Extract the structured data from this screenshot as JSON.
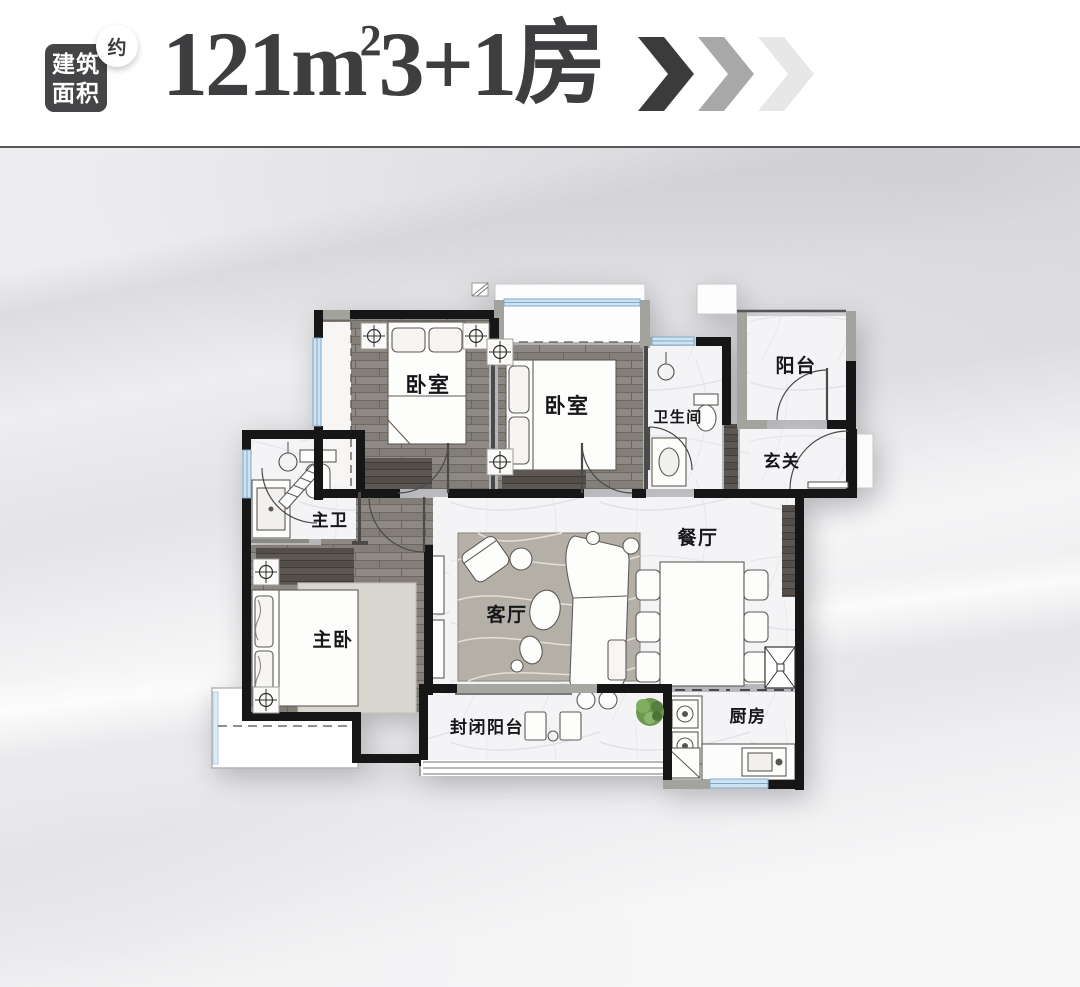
{
  "header": {
    "badge": {
      "line1": "建筑",
      "line2": "面积",
      "approx": "约"
    },
    "title": {
      "number_unit": "121m",
      "superscript": "2",
      "suffix": "3+1房"
    },
    "chevrons": [
      "#3b3b3b",
      "#a8a8a8",
      "#e7e7e7"
    ]
  },
  "floorplan": {
    "rooms": [
      {
        "id": "bedroom-1",
        "label": "卧室",
        "x": 428,
        "y": 392,
        "size": 21
      },
      {
        "id": "bedroom-2",
        "label": "卧室",
        "x": 567,
        "y": 413,
        "size": 21
      },
      {
        "id": "bathroom",
        "label": "卫生间",
        "x": 678,
        "y": 422,
        "size": 15
      },
      {
        "id": "balcony",
        "label": "阳台",
        "x": 796,
        "y": 372,
        "size": 19
      },
      {
        "id": "foyer",
        "label": "玄关",
        "x": 782,
        "y": 467,
        "size": 17
      },
      {
        "id": "dining-room",
        "label": "餐厅",
        "x": 698,
        "y": 544,
        "size": 19
      },
      {
        "id": "living-room",
        "label": "客厅",
        "x": 507,
        "y": 621,
        "size": 19
      },
      {
        "id": "master-bathroom",
        "label": "主卫",
        "x": 330,
        "y": 526,
        "size": 17
      },
      {
        "id": "master-bedroom",
        "label": "主卧",
        "x": 333,
        "y": 646,
        "size": 19
      },
      {
        "id": "enclosed-balcony",
        "label": "封闭阳台",
        "x": 487,
        "y": 733,
        "size": 17
      },
      {
        "id": "kitchen",
        "label": "厨房",
        "x": 748,
        "y": 722,
        "size": 17
      }
    ]
  },
  "colors": {
    "wall": "#161616",
    "concrete": "#a3a39d",
    "wood_floor": "#8e8984",
    "wood_dark": "#5c5753",
    "marble": "#f4f4f6",
    "window": "#cfe2f0",
    "rug": "#b5b0a7",
    "plant": "#6d9850",
    "title_text": "#3e3e40"
  }
}
